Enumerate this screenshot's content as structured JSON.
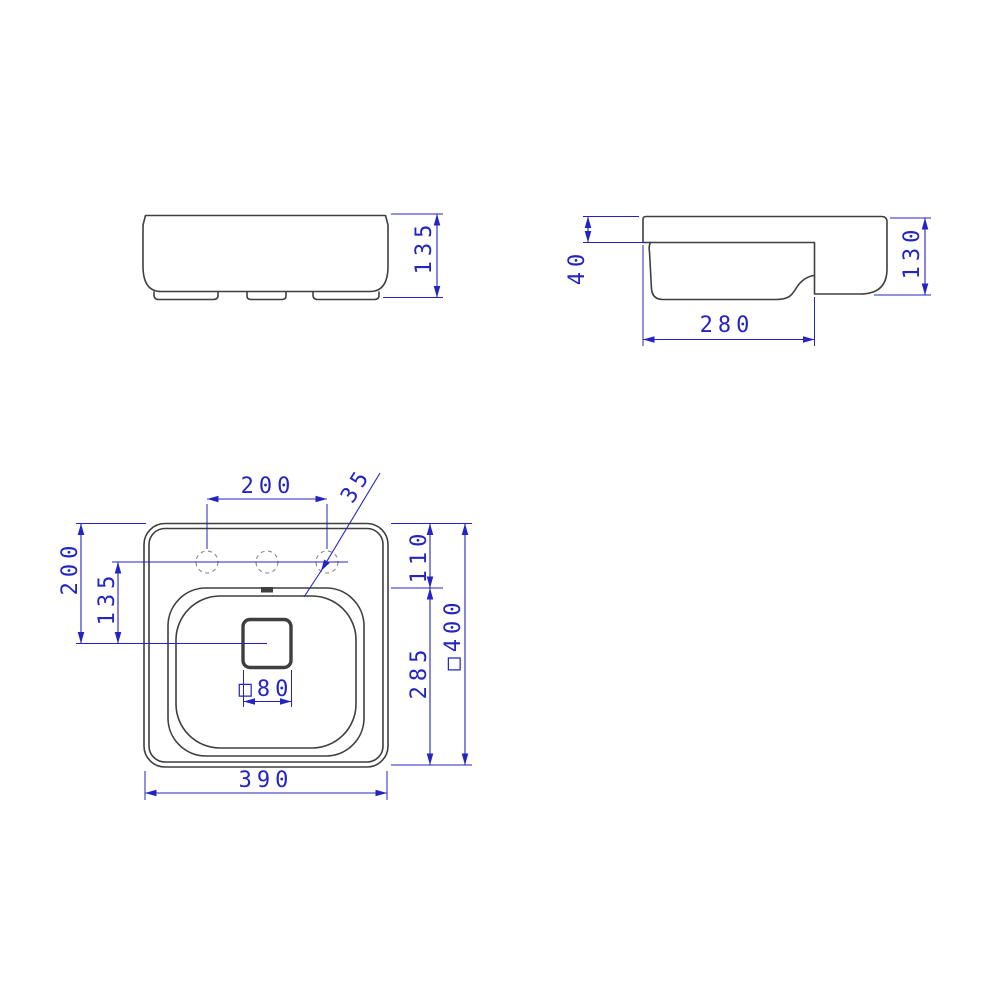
{
  "drawing": {
    "front_view": {
      "height_label": "135"
    },
    "side_view": {
      "rim_height_label": "40",
      "height_label": "130",
      "bowl_depth_label": "280"
    },
    "plan_view": {
      "hole_spacing_label": "200",
      "hole_diameter_label": "35",
      "edge_to_drain_label": "200",
      "holes_to_drain_label": "135",
      "top_to_bowl_label": "110",
      "bowl_depth_label": "285",
      "overall_size_label": "□400",
      "drain_size_label": "□80",
      "width_label": "390"
    }
  },
  "colors": {
    "background": "#ffffff",
    "line": "#3f3f3f",
    "dimension": "#2424c3",
    "hole_dash": "#8a8a8a"
  }
}
